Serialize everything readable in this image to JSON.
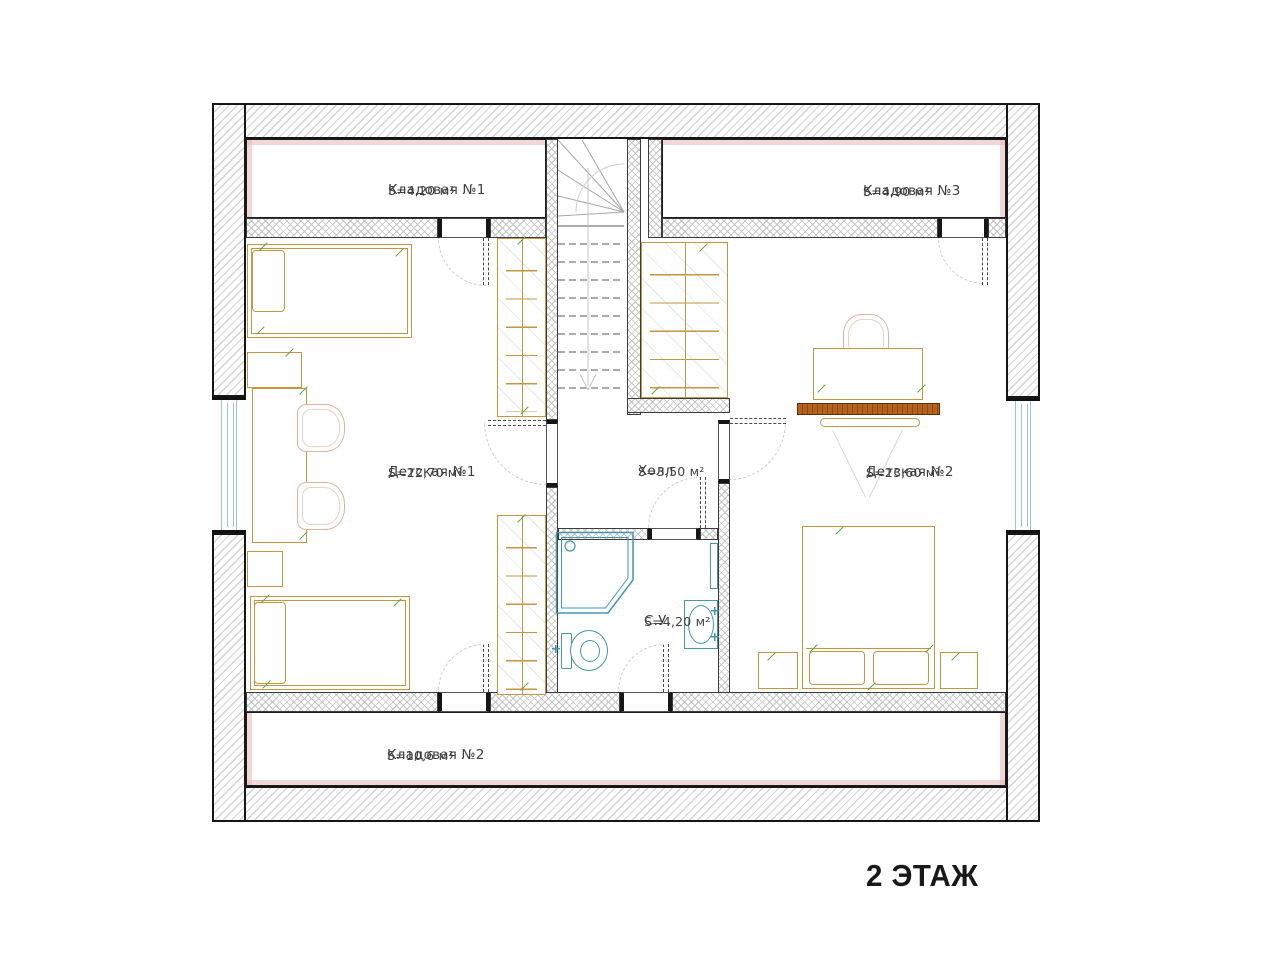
{
  "floor_label": "2 ЭТАЖ",
  "rooms": [
    {
      "id": "storage1",
      "name": "Кладовая №1",
      "area": "S=4,20 м²"
    },
    {
      "id": "storage3",
      "name": "Кладовая №3",
      "area": "S=4,90 м²"
    },
    {
      "id": "kids1",
      "name": "Детская №1",
      "area": "S=22,70 м²"
    },
    {
      "id": "hall",
      "name": "Холл",
      "area": "S=3,50 м²"
    },
    {
      "id": "kids2",
      "name": "Детская №2",
      "area": "S=23,60 м²"
    },
    {
      "id": "bathroom",
      "name": "С.У.",
      "area": "S=4,20 м²"
    },
    {
      "id": "storage2",
      "name": "Кладовая №2",
      "area": "S=10,6 м²"
    }
  ],
  "palette": {
    "line": "#161616",
    "hatch": "#d3d3d3",
    "xhatch": "#c6c6c6",
    "pink": "#e7b7b78c",
    "tan": "#c6953f",
    "cpink": "#e4b19c",
    "green": "#5fa83d",
    "blue": "#4295b5",
    "wblue": "#9cc4d4",
    "brown": "#b4621e",
    "text": "#3f3f3f",
    "arc": "#d2cbc1"
  }
}
